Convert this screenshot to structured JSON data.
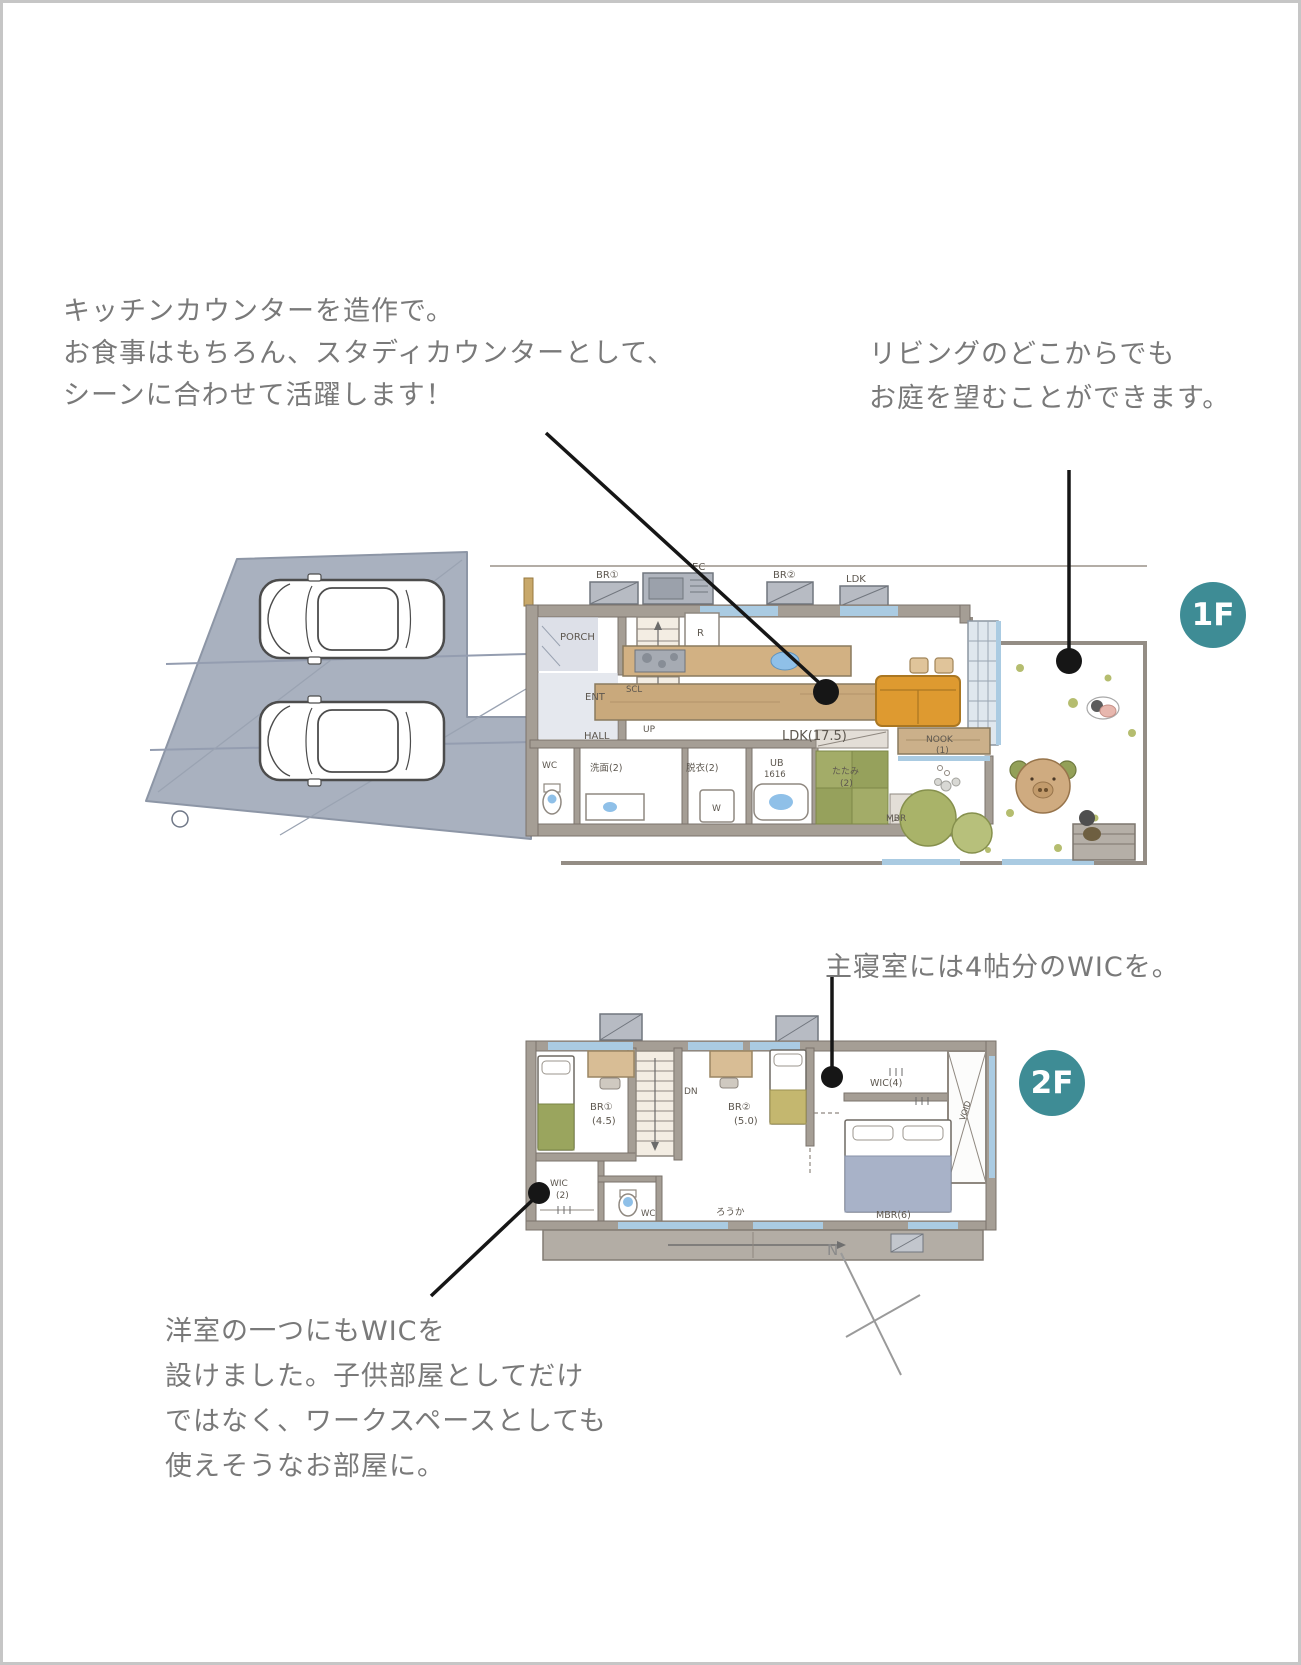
{
  "annotations": {
    "kitchen_counter": {
      "line1": "キッチンカウンターを造作で。",
      "line2": "お食事はもちろん、スタディカウンターとして、",
      "line3": "シーンに合わせて活躍します！"
    },
    "living_garden": {
      "line1": "リビングのどこからでも",
      "line2": "お庭を望むことができます。"
    },
    "master_wic": {
      "line1": "主寝室には4帖分のWICを。"
    },
    "kids_wic": {
      "line1": "洋室の一つにもWICを",
      "line2": "設けました。子供部屋としてだけ",
      "line3": "ではなく、ワークスペースとしても",
      "line4": "使えそうなお部屋に。"
    }
  },
  "badges": {
    "floor1": "1F",
    "floor2": "2F"
  },
  "plan1f": {
    "labels": {
      "ac_br1": "BR①",
      "ac_ec": "EC",
      "ac_br2": "BR②",
      "ac_ldk": "LDK",
      "porch": "PORCH",
      "ent": "ENT",
      "scl": "SCL",
      "hall": "HALL",
      "up": "UP",
      "fridge": "R",
      "wc": "WC",
      "senmen": "洗面(2)",
      "datsui": "脱衣(2)",
      "ub_line1": "UB",
      "ub_line2": "1616",
      "washer": "W",
      "ldk": "LDK(17.5)",
      "tatami_line1": "たたみ",
      "tatami_line2": "(2)",
      "mbr": "MBR",
      "nook_line1": "NOOK",
      "nook_line2": "(1)"
    }
  },
  "plan2f": {
    "labels": {
      "br1": "BR①",
      "br1_size": "(4.5)",
      "dn": "DN",
      "br2": "BR②",
      "br2_size": "(5.0)",
      "wic4": "WIC(4)",
      "wic2": "WIC",
      "wic2_size": "(2)",
      "wc": "WC",
      "corridor": "ろうか",
      "mbr": "MBR(6)",
      "void": "VOID"
    }
  },
  "compass": {
    "north": "N"
  },
  "colors": {
    "badge_teal": "#3E8C95",
    "leader_black": "#161616",
    "note_gray": "#797979",
    "parking_gray": "#A9B1BF",
    "wall_gray": "#A59E95",
    "window_blue": "#AACBE2",
    "wood_tan": "#D2B183",
    "counter_tan": "#C9A97C",
    "sofa_orange": "#DE9A30",
    "tatami_green": "#A3AC68",
    "bed_green": "#9AA55E",
    "bed_olive": "#C4B76F",
    "bed_blue": "#A8B2C8",
    "water_blue": "#8FC0E8",
    "garden_olive": "#B5BD6F"
  }
}
